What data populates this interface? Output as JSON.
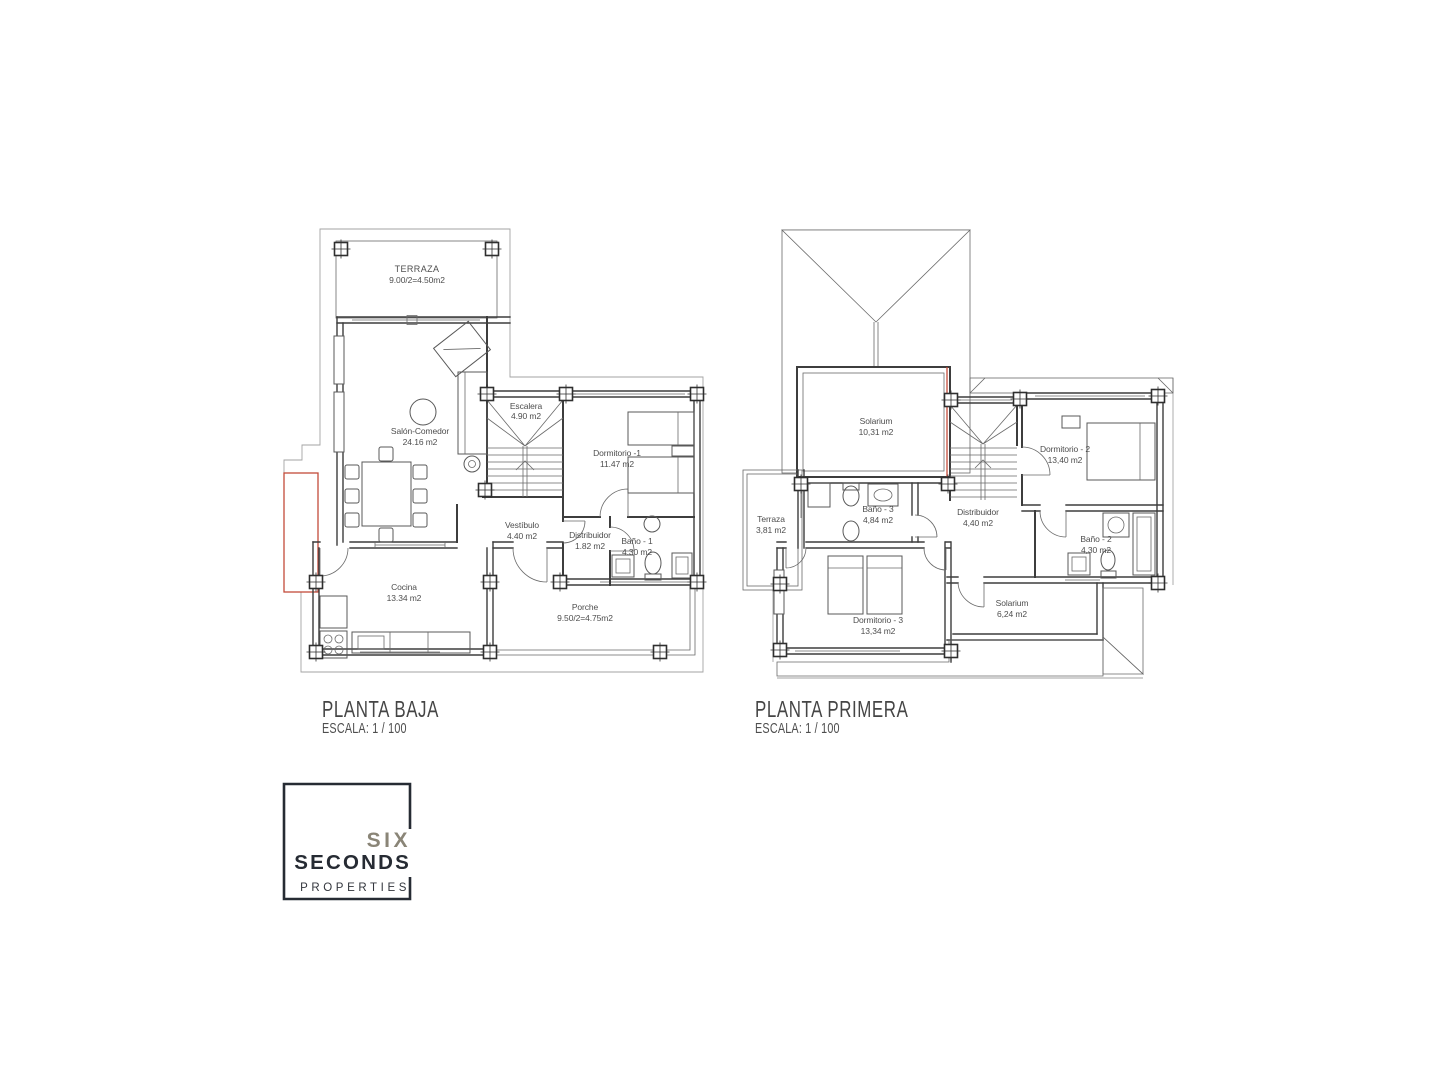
{
  "page": {
    "background": "#ffffff"
  },
  "plans": [
    {
      "title": "PLANTA BAJA",
      "scale_label": "ESCALA: 1 / 100",
      "rooms": [
        {
          "name": "TERRAZA",
          "area": "9.00/2=4.50m2"
        },
        {
          "name": "Salón-Comedor",
          "area": "24.16 m2"
        },
        {
          "name": "Escalera",
          "area": "4.90 m2"
        },
        {
          "name": "Dormitorio -1",
          "area": "11.47 m2"
        },
        {
          "name": "Vestíbulo",
          "area": "4.40 m2"
        },
        {
          "name": "Distribuidor",
          "area": "1.82 m2"
        },
        {
          "name": "Baño - 1",
          "area": "4.30 m2"
        },
        {
          "name": "Cocina",
          "area": "13.34 m2"
        },
        {
          "name": "Porche",
          "area": "9.50/2=4.75m2"
        }
      ]
    },
    {
      "title": "PLANTA PRIMERA",
      "scale_label": "ESCALA: 1 / 100",
      "rooms": [
        {
          "name": "Solarium",
          "area": "10,31 m2"
        },
        {
          "name": "Terraza",
          "area": "3,81 m2"
        },
        {
          "name": "Baño - 3",
          "area": "4,84 m2"
        },
        {
          "name": "Distribuidor",
          "area": "4,40 m2"
        },
        {
          "name": "Dormitorio - 2",
          "area": "13,40 m2"
        },
        {
          "name": "Baño - 2",
          "area": "4,30 m2"
        },
        {
          "name": "Dormitorio - 3",
          "area": "13,34 m2"
        },
        {
          "name": "Solarium",
          "area": "6,24 m2"
        }
      ]
    }
  ],
  "logo": {
    "line1": "SIX",
    "line2": "SECONDS",
    "line3": "PROPERTIES"
  },
  "colors": {
    "wall_line": "#3d3d3d",
    "annotation_red": "#c24b3a",
    "logo_accent": "#8a8577",
    "logo_dark": "#262b33",
    "hatch": "#8f8f8f"
  }
}
